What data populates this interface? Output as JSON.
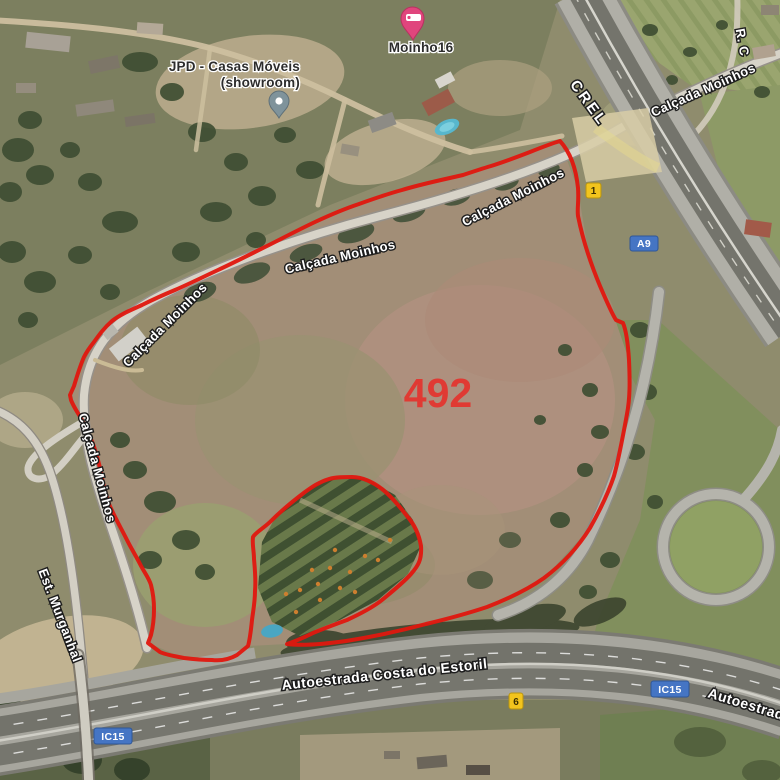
{
  "parcel": {
    "area_label": "492"
  },
  "road_labels": {
    "calcada_moinhos": "Calçada Moinhos",
    "crel": "CREL",
    "r_c": "R. C",
    "est_murganhal": "Est. Murganhal",
    "autoestrada_costa_do_estoril": "Autoestrada Costa do Estoril",
    "autoestrada_clipped": "Autoestrada"
  },
  "route_shields": {
    "n1": "1",
    "a9": "A9",
    "ic15": "IC15",
    "n6": "6"
  },
  "places": {
    "moinho16": {
      "name": "Moinho16"
    },
    "jpd": {
      "name_line1": "JPD - Casas Móveis",
      "name_line2": "(showroom)"
    }
  },
  "colors": {
    "parcel_outline": "#e0170f",
    "parcel_label": "#e03a33",
    "motorway_shield_blue": "#4575c4",
    "national_shield_yellow": "#f2c41d",
    "lodging_pin_pink": "#e0457d",
    "generic_pin_gray": "#7f939b"
  }
}
